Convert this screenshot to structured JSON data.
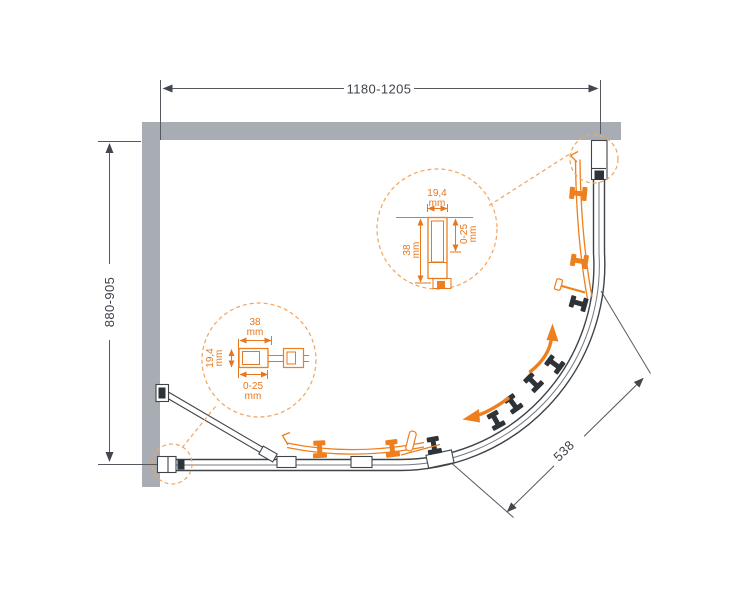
{
  "drawing": {
    "dimensions": {
      "width": "1180-1205",
      "depth": "880-905",
      "diagonal": "538"
    },
    "detail_top": {
      "profile_width": "19,4",
      "profile_width_unit": "mm",
      "profile_height": "38",
      "profile_height_unit": "mm",
      "adjustment": "0-25",
      "adjustment_unit": "mm"
    },
    "detail_bottom": {
      "profile_width": "38",
      "profile_width_unit": "mm",
      "profile_height": "19,4",
      "profile_height_unit": "mm",
      "adjustment": "0-25",
      "adjustment_unit": "mm"
    },
    "colors": {
      "wall_gray": "#a8adb3",
      "dimension_dark": "#3e434a",
      "accent_orange": "#ee7f1e",
      "dashed_orange": "#f0a55f",
      "hardware_dark": "#2e3338"
    }
  }
}
